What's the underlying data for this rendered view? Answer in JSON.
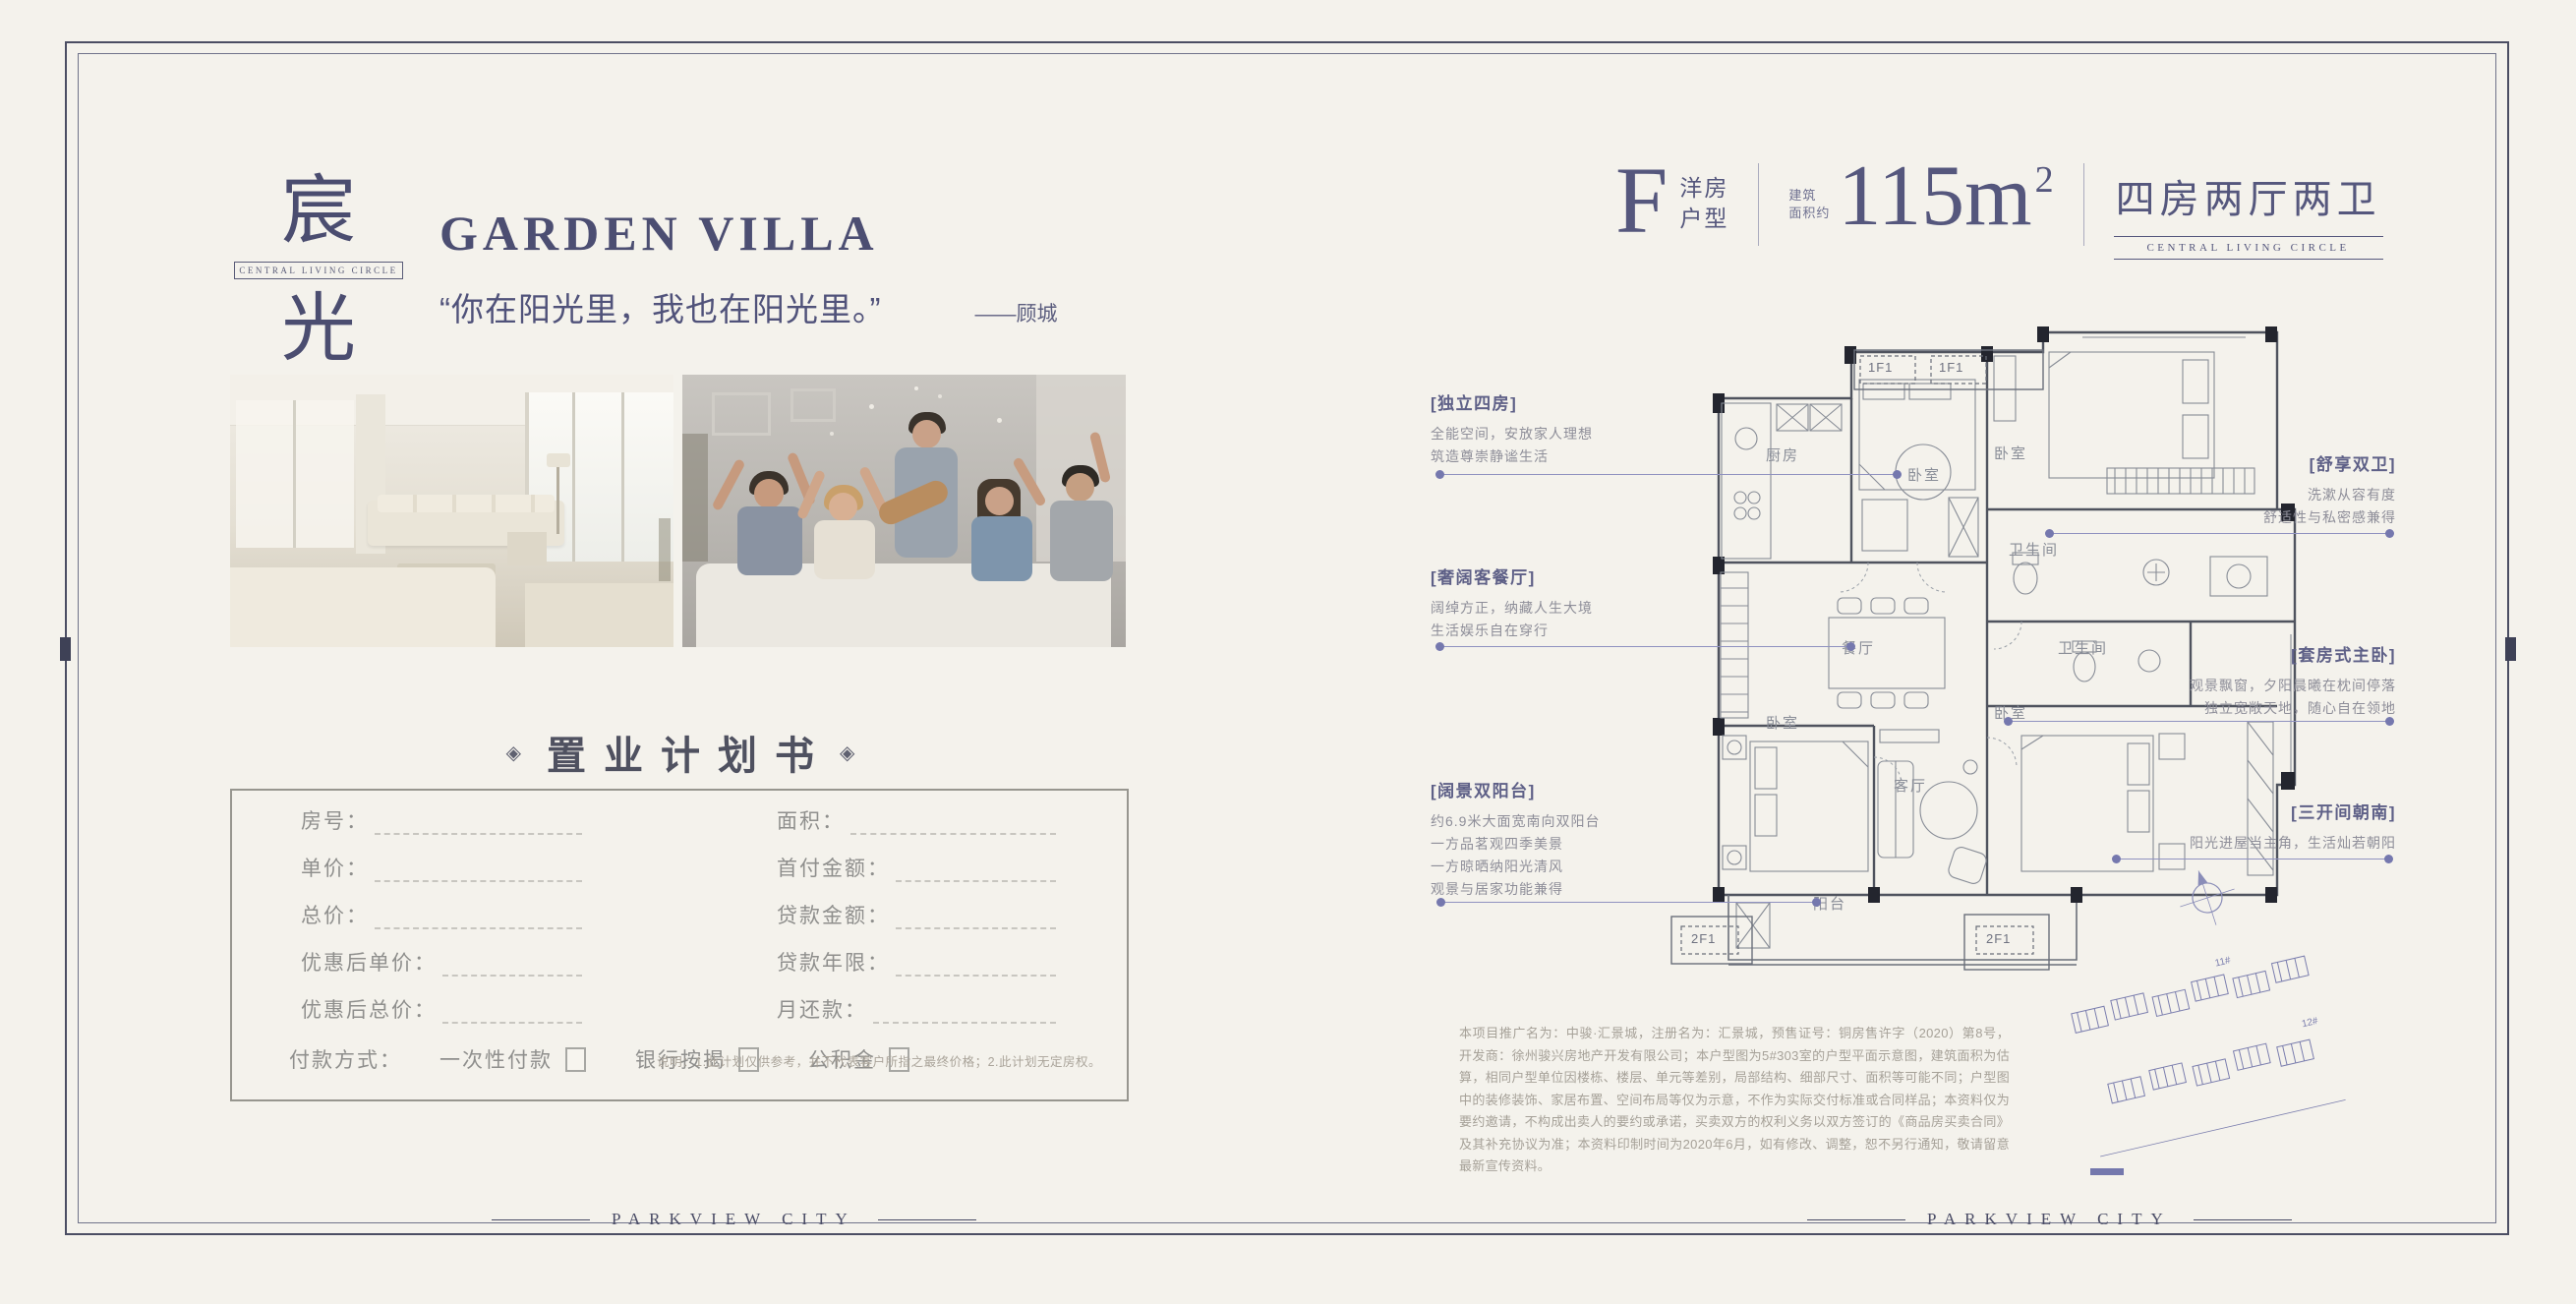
{
  "brand": {
    "logo_top": "宸",
    "logo_bottom": "光",
    "tagline": "CENTRAL LIVING CIRCLE",
    "footer_wordmark": "PARKVIEW CITY",
    "accent_color": "#4f5176"
  },
  "left_page": {
    "title": "GARDEN VILLA",
    "quote": "“你在阳光里，我也在阳光里。”",
    "quote_author": "——顾城",
    "plan_book": {
      "ornament": "◈",
      "title": "置业计划书",
      "fields_left": [
        "房号：",
        "单价：",
        "总价：",
        "优惠后单价：",
        "优惠后总价："
      ],
      "fields_right": [
        "面积：",
        "首付金额：",
        "贷款金额：",
        "贷款年限：",
        "月还款："
      ],
      "payment_label": "付款方式：",
      "payment_options": [
        "一次性付款",
        "银行按揭",
        "公积金"
      ],
      "note": "说明：1.此计划仅供参考，并不代表客户所指之最终价格；2.此计划无定房权。"
    }
  },
  "right_page": {
    "header": {
      "letter": "F",
      "type_line1": "洋房",
      "type_line2": "户型",
      "area_prefix_line1": "建筑",
      "area_prefix_line2": "面积约",
      "area_value": "115m",
      "area_sup": "2",
      "layout_name": "四房两厅两卫",
      "layout_sub": "CENTRAL LIVING CIRCLE"
    },
    "floorplan": {
      "rooms": [
        "厨房",
        "卧室",
        "卧室",
        "卫生间",
        "餐厅",
        "卫生间",
        "卧室",
        "客厅",
        "卧室",
        "阳台"
      ],
      "unit_tags": [
        "1F1",
        "1F1",
        "2F1",
        "2F1"
      ],
      "site_labels": [
        "11#",
        "12#"
      ]
    },
    "annotations": [
      {
        "title": "[独立四房]",
        "lines": [
          "全能空间，安放家人理想",
          "筑造尊崇静谧生活"
        ]
      },
      {
        "title": "[奢阔客餐厅]",
        "lines": [
          "阔绰方正，纳藏人生大境",
          "生活娱乐自在穿行"
        ]
      },
      {
        "title": "[阔景双阳台]",
        "lines": [
          "约6.9米大面宽南向双阳台",
          "一方品茗观四季美景",
          "一方晾晒纳阳光清风",
          "观景与居家功能兼得"
        ]
      },
      {
        "title": "[舒享双卫]",
        "lines": [
          "洗漱从容有度",
          "舒适性与私密感兼得"
        ]
      },
      {
        "title": "[套房式主卧]",
        "lines": [
          "观景飘窗，夕阳晨曦在枕间停落",
          "独立宽敞天地，随心自在领地"
        ]
      },
      {
        "title": "[三开间朝南]",
        "lines": [
          "阳光进屋当主角，生活灿若朝阳"
        ]
      }
    ],
    "disclaimer": "本项目推广名为：中骏·汇景城，注册名为：汇景城，预售证号：铜房售许字（2020）第8号，开发商：徐州骏兴房地产开发有限公司；本户型图为5#303室的户型平面示意图，建筑面积为估算，相同户型单位因楼栋、楼层、单元等差别，局部结构、细部尺寸、面积等可能不同；户型图中的装修装饰、家居布置、空间布局等仅为示意，不作为实际交付标准或合同样品；本资料仅为要约邀请，不构成出卖人的要约或承诺，买卖双方的权利义务以双方签订的《商品房买卖合同》及其补充协议为准；本资料印制时间为2020年6月，如有修改、调整，恕不另行通知，敬请留意最新宣传资料。"
  }
}
